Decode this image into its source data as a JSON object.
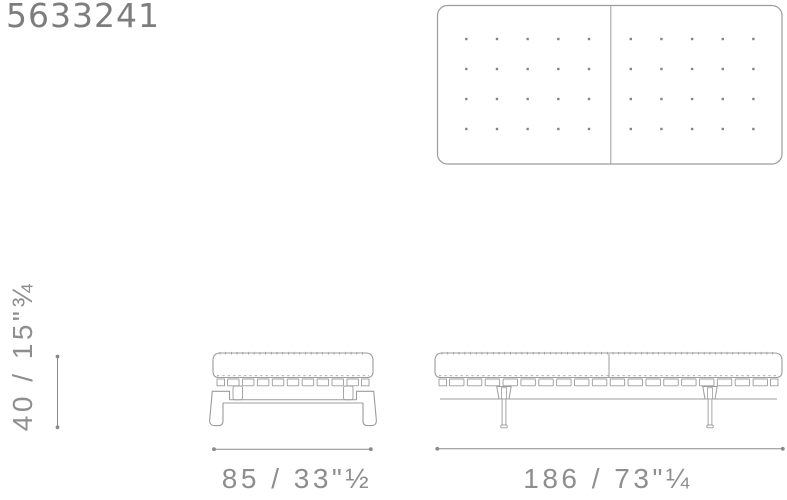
{
  "product": {
    "code": "5633241"
  },
  "colors": {
    "line": "#9c9c9c",
    "dot": "#858585",
    "dim_line": "#8a8a8a",
    "label_text": "#8e8e8e",
    "code_text": "#7d7d7d"
  },
  "top_view": {
    "panels": 2,
    "button_rows": 4,
    "button_cols_per_panel": 5
  },
  "drawing": {
    "ottoman_strap_count": 9,
    "bench_strap_count": 18
  },
  "dimensions": {
    "height_label": "40 / 15\"¾",
    "ottoman_width_label": "85 / 33\"½",
    "bench_width_label": "186 / 73\"¼"
  }
}
